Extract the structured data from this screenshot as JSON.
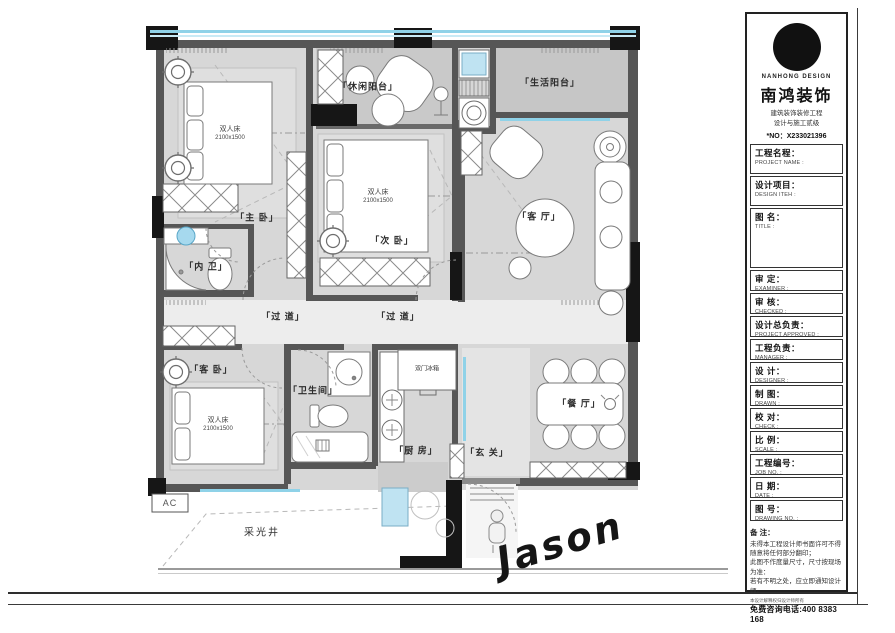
{
  "floor_plan": {
    "rooms": {
      "master": "「主 卧」",
      "second": "「次 卧」",
      "living": "「客 厅」",
      "inner_bath": "「内 卫」",
      "guest": "「客 卧」",
      "bathroom": "「卫生间」",
      "kitchen": "「厨 房」",
      "entry": "「玄 关」",
      "dining": "「餐 厅」",
      "corridor": "「过 道」",
      "leisure_balcony": "「休闲阳台」",
      "life_balcony": "「生活阳台」",
      "light_well": "采光井",
      "ac": "AC"
    },
    "bed": {
      "name": "双人床",
      "size": "2100x1500"
    },
    "fridge_label": "双门冰箱",
    "signature": "Jason"
  },
  "title_block": {
    "brand": {
      "name_en": "NANHONG DESIGN",
      "name_cn": "南鸿装饰",
      "cert": "建筑装饰装修工程\n设计与施工贰级",
      "cert_no": "*NO：X233021396"
    },
    "fields": [
      {
        "cn": "工程名程：",
        "en": "PROJECT NAME :"
      },
      {
        "cn": "设计项目：",
        "en": "DESIGN ITEH :"
      },
      {
        "cn": "图 名：",
        "en": "TITLE :"
      },
      {
        "cn": "审 定：",
        "en": "EXAMINER :"
      },
      {
        "cn": "审 核：",
        "en": "CHECKED :"
      },
      {
        "cn": "设计总负责：",
        "en": "PROJECT APPROVED :"
      },
      {
        "cn": "工程负责：",
        "en": "MANAGER :"
      },
      {
        "cn": "设 计：",
        "en": "DESIGNER :"
      },
      {
        "cn": "制 图：",
        "en": "DRAWN :"
      },
      {
        "cn": "校 对：",
        "en": "CHECK :"
      },
      {
        "cn": "比 例：",
        "en": "SCALE :"
      },
      {
        "cn": "工程编号：",
        "en": "JOB NO. :"
      },
      {
        "cn": "日 期：",
        "en": "DATE :"
      },
      {
        "cn": "图 号：",
        "en": "DRAWING NO. :"
      }
    ],
    "remarks": {
      "title": "备 注：",
      "body": "未得本工程设计师书面许可不得\n随意将任何部分翻印；\n此图不作度量尺寸，尺寸按现场\n为准：\n若有不明之处，应立即通知设计\n师。",
      "small": "本设计解释权归设计师所有",
      "phone": "免费咨询电话:400 8383 168"
    }
  }
}
